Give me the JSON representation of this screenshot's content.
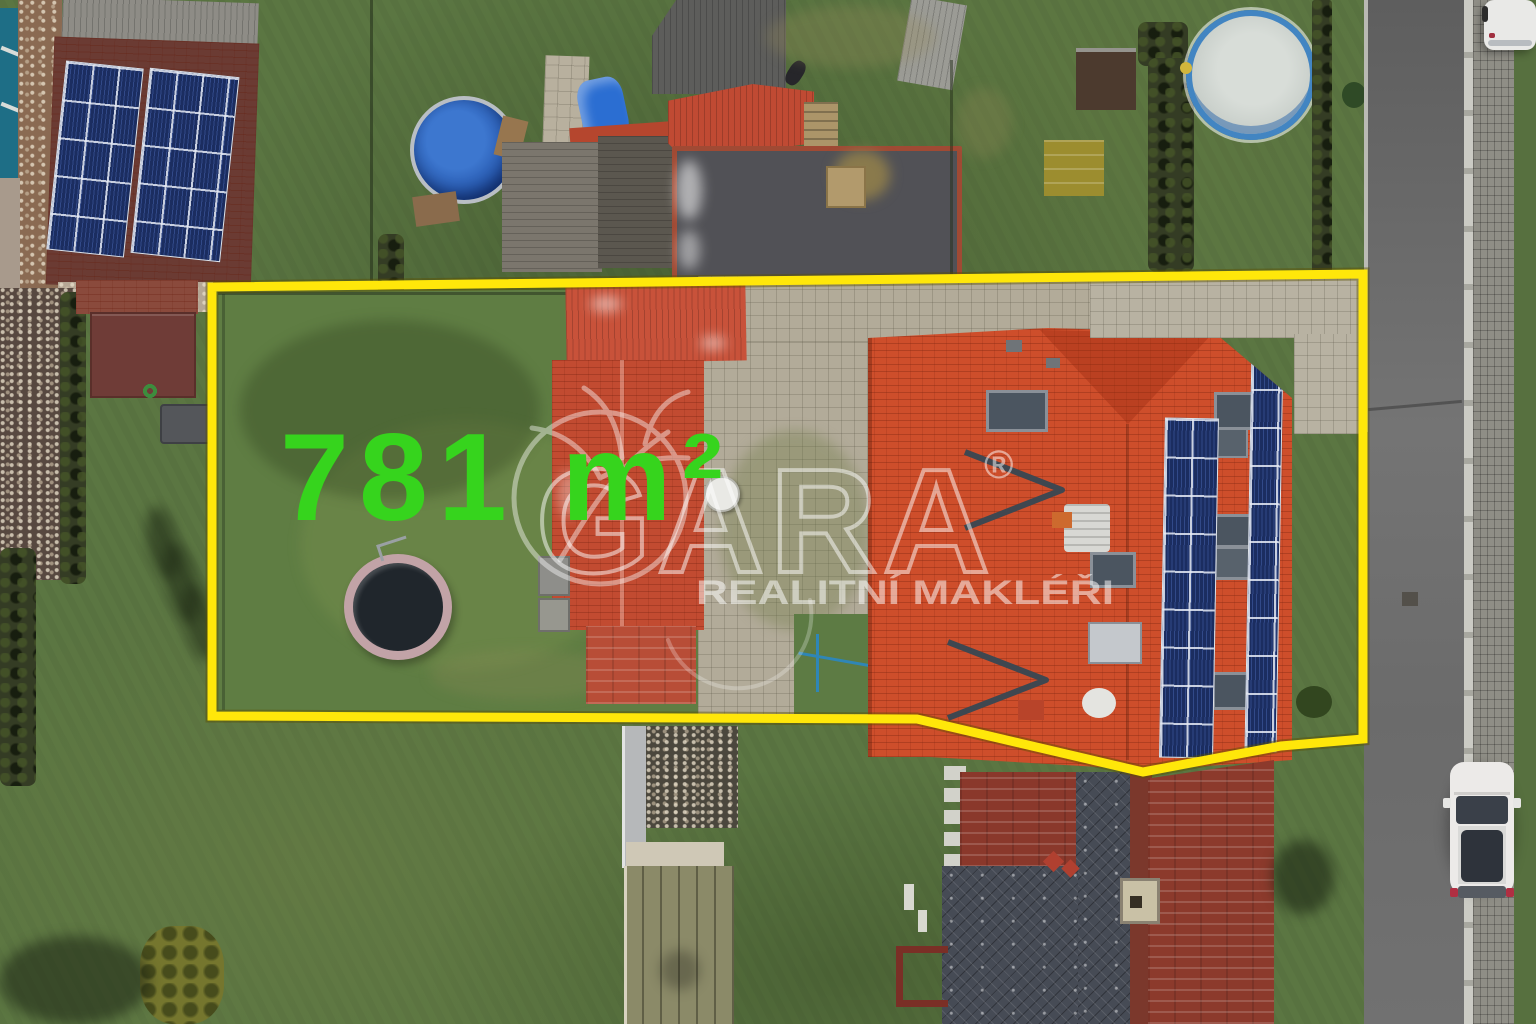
{
  "overlay": {
    "area_label": "781 m²",
    "area_text_color": "#36d41d",
    "boundary_color": "#ffe70a"
  },
  "watermark": {
    "brand": "GARA",
    "registered_mark": "®",
    "tagline": "REALITNÍ MAKLÉŘI",
    "color": "#ffffff"
  },
  "palette": {
    "grass": "#5b7642",
    "main_roof": "#ce4e2b",
    "weathered_roof": "#8a382b",
    "slate_roof": "#464b55",
    "solar_panel": "#1b2d60",
    "asphalt_road": "#6a6a6a",
    "paving": "#b2ab99",
    "pool_water": "#2456ae",
    "pool_empty": "#ccd2cc"
  }
}
